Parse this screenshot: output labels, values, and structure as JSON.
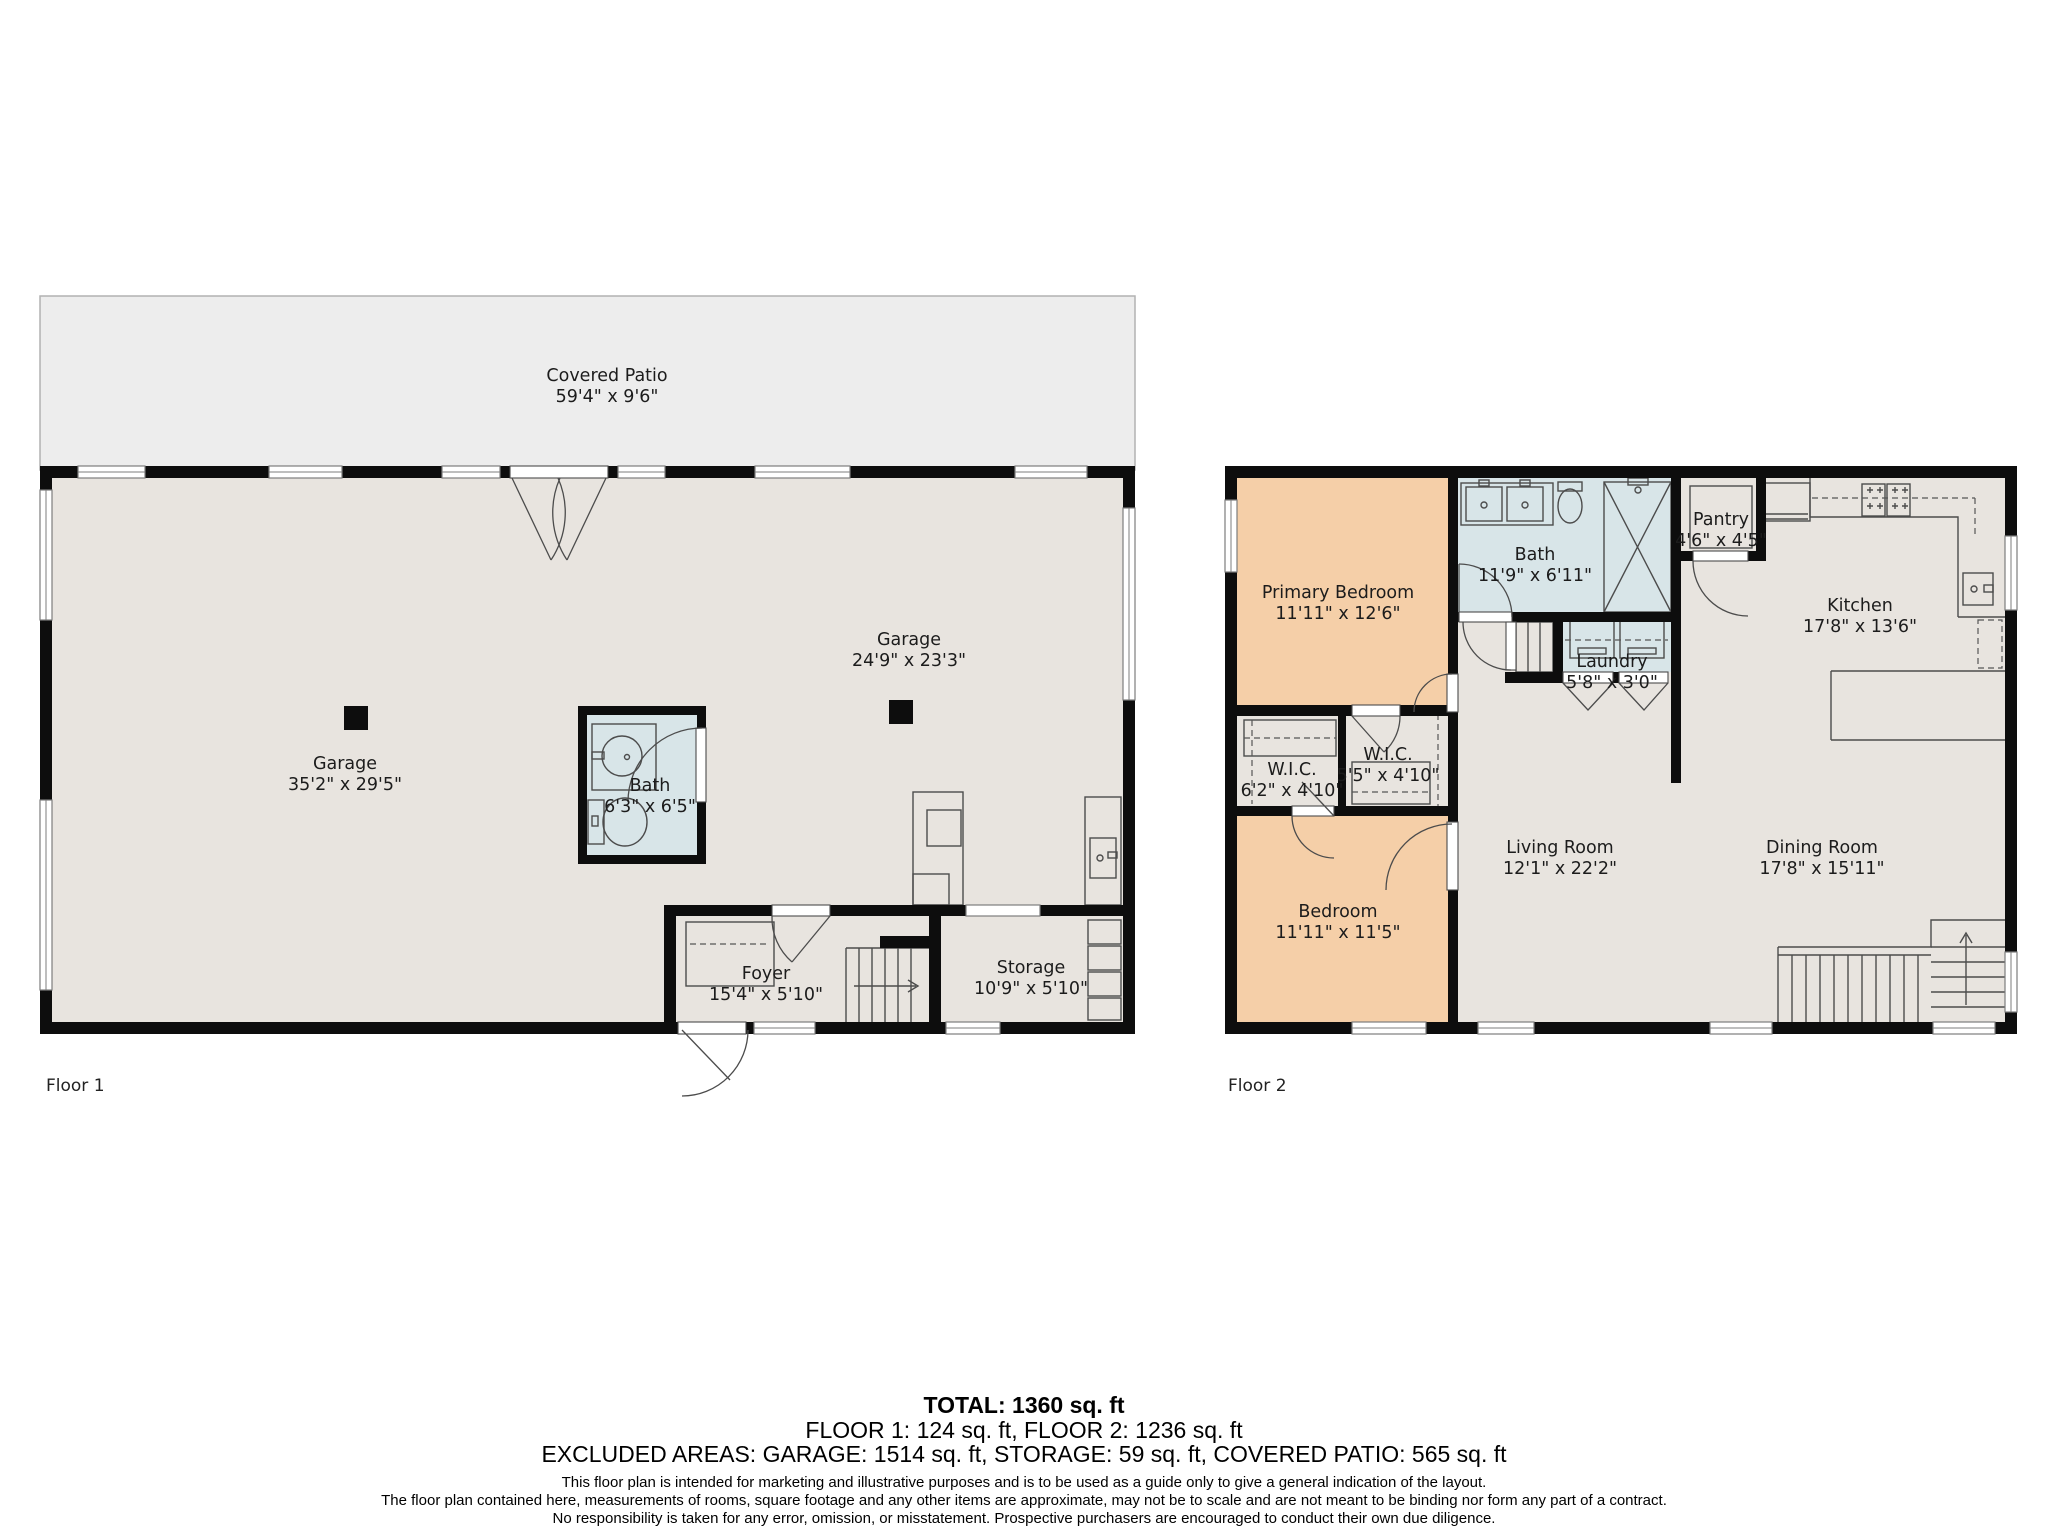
{
  "floor1": {
    "label": "Floor 1",
    "rooms": {
      "covered_patio": {
        "name": "Covered Patio",
        "dims": "59'4\" x 9'6\""
      },
      "garage_main": {
        "name": "Garage",
        "dims": "35'2\" x 29'5\""
      },
      "garage_side": {
        "name": "Garage",
        "dims": "24'9\" x 23'3\""
      },
      "bath": {
        "name": "Bath",
        "dims": "6'3\" x 6'5\""
      },
      "foyer": {
        "name": "Foyer",
        "dims": "15'4\" x 5'10\""
      },
      "storage": {
        "name": "Storage",
        "dims": "10'9\" x 5'10\""
      }
    }
  },
  "floor2": {
    "label": "Floor 2",
    "rooms": {
      "primary_bedroom": {
        "name": "Primary Bedroom",
        "dims": "11'11\" x 12'6\""
      },
      "bath": {
        "name": "Bath",
        "dims": "11'9\" x 6'11\""
      },
      "pantry": {
        "name": "Pantry",
        "dims": "4'6\" x 4'5\""
      },
      "kitchen": {
        "name": "Kitchen",
        "dims": "17'8\" x 13'6\""
      },
      "laundry": {
        "name": "Laundry",
        "dims": "5'8\" x 3'0\""
      },
      "wic_left": {
        "name": "W.I.C.",
        "dims": "6'2\" x 4'10\""
      },
      "wic_right": {
        "name": "W.I.C.",
        "dims": "5'5\" x 4'10\""
      },
      "living_room": {
        "name": "Living Room",
        "dims": "12'1\" x 22'2\""
      },
      "bedroom": {
        "name": "Bedroom",
        "dims": "11'11\" x 11'5\""
      },
      "dining_room": {
        "name": "Dining Room",
        "dims": "17'8\" x 15'11\""
      }
    }
  },
  "summary": {
    "total": "TOTAL: 1360 sq. ft",
    "floors": "FLOOR 1: 124 sq. ft, FLOOR 2: 1236 sq. ft",
    "excluded": "EXCLUDED AREAS: GARAGE: 1514 sq. ft, STORAGE: 59 sq. ft, COVERED PATIO: 565 sq. ft"
  },
  "disclaimer": {
    "line1": "This floor plan is intended for marketing and illustrative purposes and is to be used as a guide only to give a general indication of the layout.",
    "line2": "The floor plan contained here, measurements of rooms, square footage and any other items are approximate, may not be to scale and are not meant to be binding nor form any part of a contract.",
    "line3": "No responsibility is taken for any error, omission, or misstatement. Prospective purchasers are encouraged to conduct their own due diligence."
  },
  "colors": {
    "floor": "#e8e4df",
    "patio": "#ededed",
    "wet": "#d8e5e8",
    "bedroom": "#f5cfa8",
    "wall": "#0d0d0d"
  }
}
